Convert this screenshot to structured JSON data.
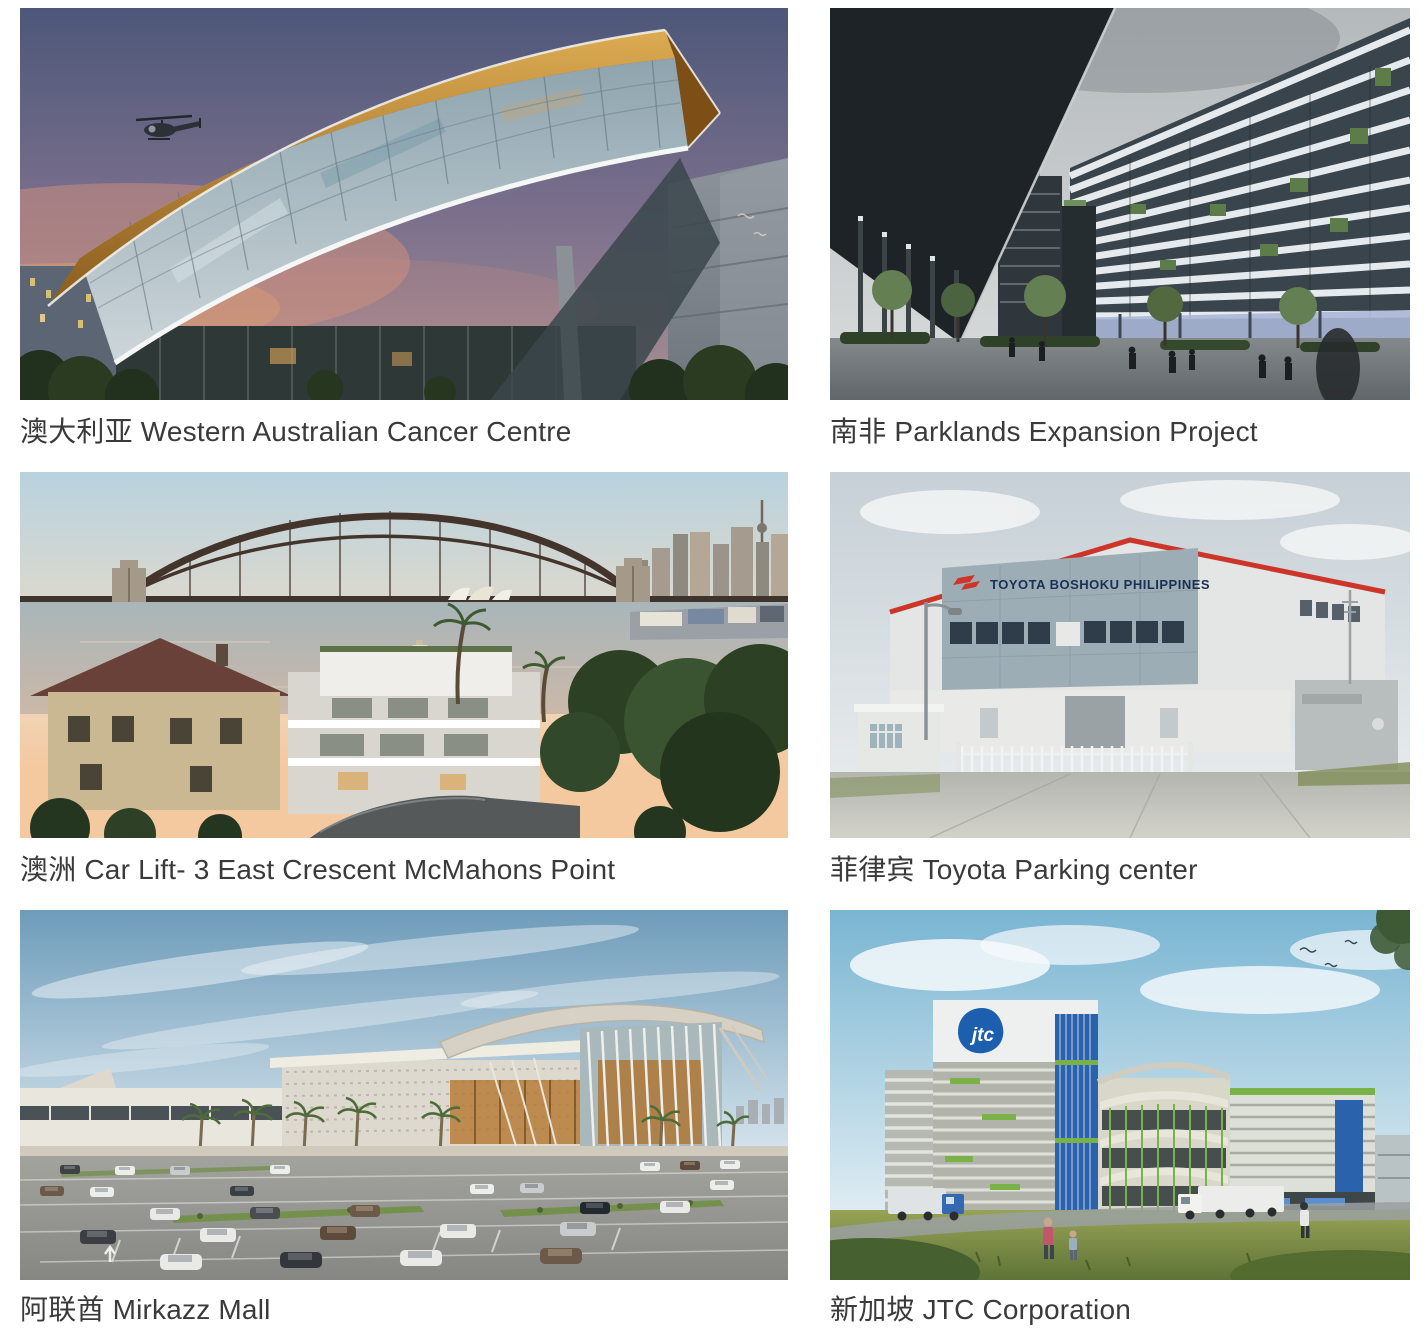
{
  "page": {
    "background": "#ffffff",
    "caption_color": "#3a3a3a"
  },
  "colors": {
    "copper_accent": "#c08a3e",
    "toyota_red": "#cc3527",
    "toyota_sign_navy": "#1d2f52",
    "jtc_blue": "#1b5fae",
    "eco_green": "#7ab248"
  },
  "gallery": {
    "items": [
      {
        "caption": "澳大利亚 Western Australian Cancer Centre"
      },
      {
        "caption": "南非 Parklands Expansion Project"
      },
      {
        "caption": "澳洲 Car Lift- 3 East Crescent McMahons Point"
      },
      {
        "caption": "菲律宾 Toyota Parking center",
        "sign_text": "TOYOTA BOSHOKU PHILIPPINES"
      },
      {
        "caption": "阿联酋 Mirkazz Mall"
      },
      {
        "caption": "新加坡 JTC Corporation",
        "logo_text": "jtc"
      }
    ]
  }
}
